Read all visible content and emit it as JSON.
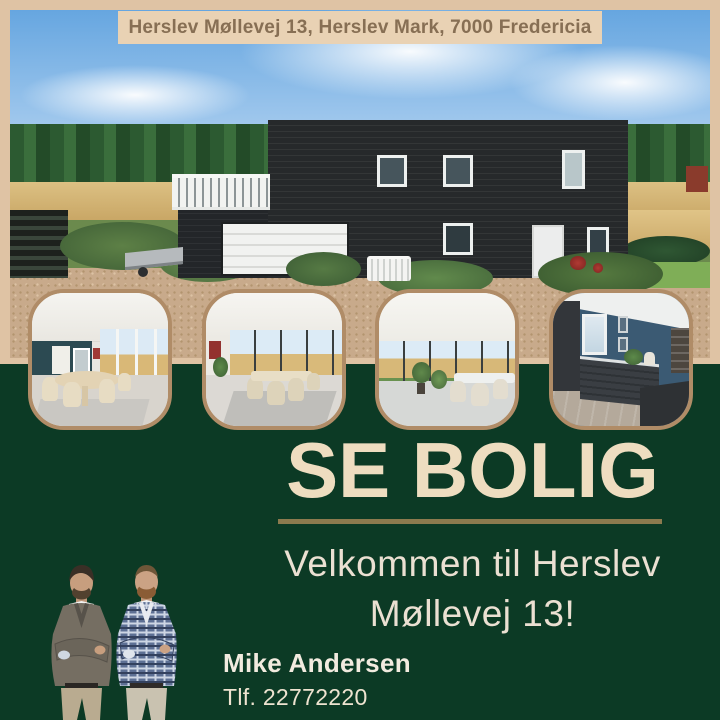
{
  "post": {
    "address_banner": "Herslev Møllevej 13, Herslev Mark, 7000 Fredericia",
    "cta_label": "SE BOLIG",
    "welcome_line1": "Velkommen til Herslev",
    "welcome_line2": "Møllevej 13!",
    "agent_name": "Mike Andersen",
    "agent_phone": "Tlf. 22772220"
  },
  "colors": {
    "frame_beige": "#dfc3a4",
    "banner_bg": "#e9d2b4",
    "banner_text": "#876f54",
    "section_green": "#0c3a25",
    "cta_text": "#eeddc0",
    "divider_gold": "#8c7a4e",
    "welcome_text": "#ebe0d2",
    "thumb_border": "#b08c67"
  },
  "gallery": {
    "main_photo": "black-wood-house-exterior",
    "thumbs": [
      "dining-room-round-table",
      "dining-room-long-table",
      "garden-room-plants",
      "kitchen-dark-blue"
    ]
  }
}
